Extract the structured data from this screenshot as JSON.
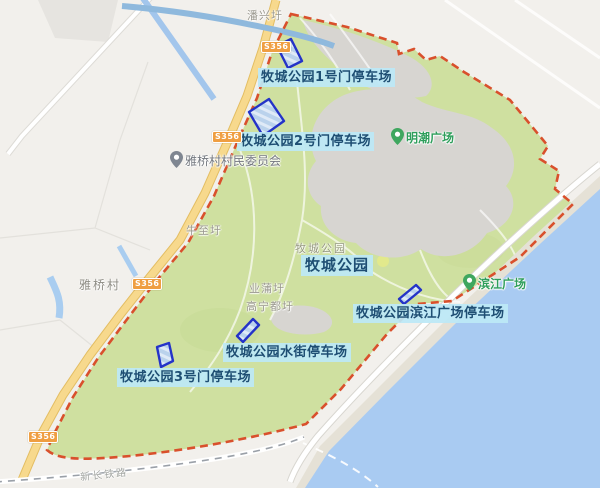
{
  "park": {
    "name": "牧城公园",
    "base_label": "牧城公园"
  },
  "parking_labels": {
    "gate1": "牧城公园1号门停车场",
    "gate2": "牧城公园2号门停车场",
    "gate3": "牧城公园3号门停车场",
    "water_street": "牧城公园水街停车场",
    "binjiang_square": "牧城公园滨江广场停车场"
  },
  "pois": {
    "village_committee": "雅桥村村民委员会",
    "mingchao_square": "明潮广场",
    "binjiang_square": "滨江广场"
  },
  "place_names": {
    "panxing_hamlet": "潘兴圩",
    "yaqiao_village": "雅桥村",
    "niuzhi_hamlet": "牛至圩",
    "yepu_hamlet": "业蒲圩",
    "gaoningdu_hamlet": "高宁都圩",
    "railway": "新长铁路"
  },
  "road_badge": {
    "label": "S356"
  },
  "colors": {
    "park_green": "#cfe0a0",
    "boundary_red": "#d9502c",
    "water_blue": "#a9cbf2",
    "beach_sand": "#e5e1d6",
    "road_yellow": "#f7d98d",
    "plaza_gray": "#d7d5d1",
    "parking_outline_blue": "#2433c8",
    "parking_fill_blue": "#bad2ec",
    "label_bg_cyan": "#bfe9f5",
    "label_text_navy": "#1e4e73",
    "poi_green": "#2e9e5b",
    "badge_orange": "#ef9e41"
  }
}
